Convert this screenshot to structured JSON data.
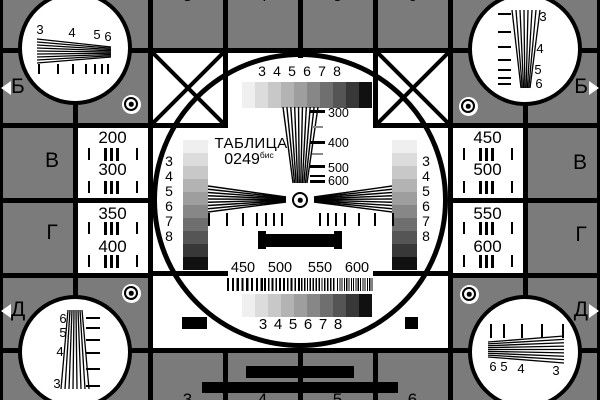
{
  "colors": {
    "background_gray": "#7b7b7b",
    "line_black": "#000000",
    "white": "#ffffff",
    "dash_gray": "#8a8a8a",
    "grayscale_steps": [
      "#efefef",
      "#dcdcdc",
      "#c8c8c8",
      "#b3b3b3",
      "#9e9e9e",
      "#878787",
      "#6f6f6f",
      "#555555",
      "#383838",
      "#111111"
    ]
  },
  "edge_markers": {
    "top_column_numbers": [
      "3",
      "4",
      "5",
      "6"
    ],
    "bottom_column_numbers": [
      "3",
      "4",
      "5",
      "6"
    ],
    "left_row_letters": [
      "Б",
      "В",
      "Г",
      "Д"
    ],
    "right_row_letters": [
      "Б",
      "В",
      "Г",
      "Д"
    ]
  },
  "side_panels": {
    "left_top": [
      "200",
      "300"
    ],
    "left_bottom": [
      "350",
      "400"
    ],
    "right_top": [
      "450",
      "500"
    ],
    "right_bottom": [
      "550",
      "600"
    ]
  },
  "center_circle": {
    "title": "ТАБЛИЦА",
    "number": "0249",
    "number_superscript": "бис",
    "top_grayscale_labels": [
      "3",
      "4",
      "5",
      "6",
      "7",
      "8"
    ],
    "bottom_grayscale_labels": [
      "3",
      "4",
      "5",
      "6",
      "7",
      "8"
    ],
    "left_grayscale_labels": [
      "3",
      "4",
      "5",
      "6",
      "7",
      "8"
    ],
    "right_grayscale_labels": [
      "3",
      "4",
      "5",
      "6",
      "7",
      "8"
    ],
    "vertical_wedge_labels": [
      "300",
      "400",
      "500",
      "600"
    ],
    "frequency_band_labels": [
      "450",
      "500",
      "550",
      "600"
    ]
  },
  "corner_circles": {
    "top_left_labels": [
      "3",
      "4",
      "5",
      "6"
    ],
    "top_right_labels": [
      "3",
      "4",
      "5",
      "6"
    ],
    "bottom_left_labels": [
      "6",
      "5",
      "4",
      "3"
    ],
    "bottom_right_labels": [
      "6",
      "5",
      "4",
      "3"
    ]
  }
}
